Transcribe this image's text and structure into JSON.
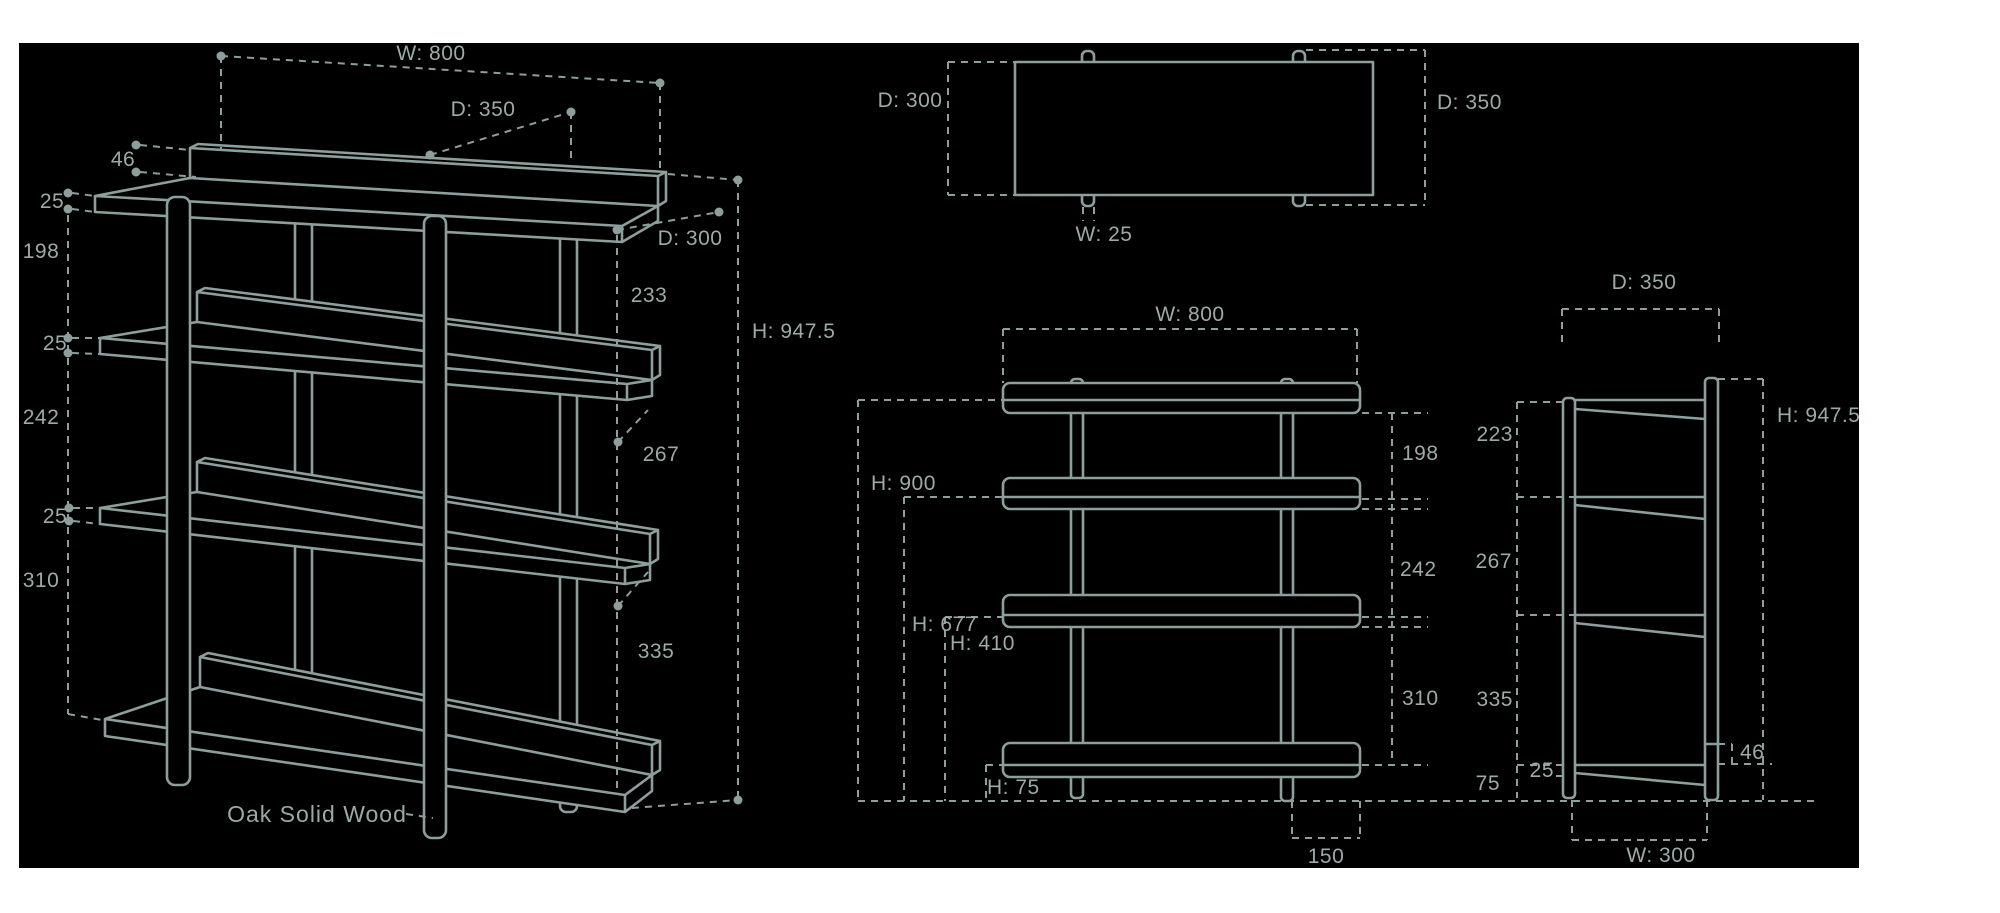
{
  "page": {
    "background": "#ffffff",
    "canvas_background": "#000000",
    "line_color": "#8c9f9c",
    "text_color": "#9aaba8"
  },
  "views": {
    "perspective": {
      "labels": {
        "width": "W: 800",
        "depth_top": "D: 350",
        "lip_height": "46",
        "board_thickness_top": "25",
        "gap_top": "198",
        "board_thickness_mid": "25",
        "gap_mid": "242",
        "board_thickness_low": "25",
        "gap_low": "310",
        "depth_board": "D: 300",
        "seg_top": "233",
        "total_height": "H: 947.5",
        "seg_mid": "267",
        "seg_low": "335",
        "material": "Oak Solid Wood"
      }
    },
    "top": {
      "labels": {
        "depth_board": "D: 300",
        "depth_total": "D: 350",
        "leg_width": "W: 25"
      }
    },
    "front": {
      "labels": {
        "width": "W: 800",
        "height_top_shelf": "H: 900",
        "height_mid_shelf": "H: 677",
        "height_low_shelf": "H: 410",
        "height_bottom_shelf": "H: 75",
        "gap_top": "198",
        "gap_mid": "242",
        "gap_low": "310",
        "leg_inset": "150"
      }
    },
    "side": {
      "labels": {
        "depth": "D: 350",
        "total_height": "H: 947.5",
        "seg1": "223",
        "seg2": "267",
        "seg3": "335",
        "seg4": "75",
        "board_thickness": "25",
        "lip_height": "46",
        "width": "W: 300"
      }
    }
  }
}
